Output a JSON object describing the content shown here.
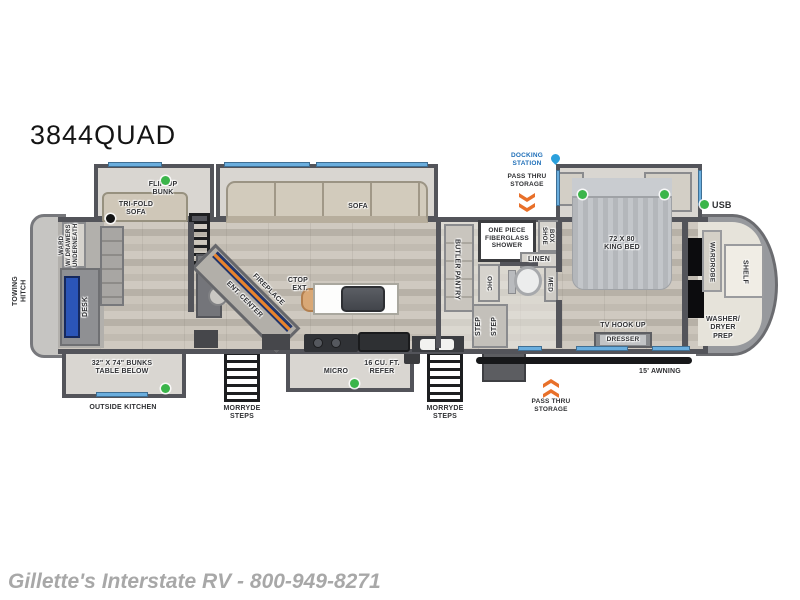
{
  "title": "3844QUAD",
  "footer": "Gillette's Interstate RV - 800-949-8271",
  "labels": {
    "towing_hitch": "TOWING HITCH",
    "ward": "WARD\nW/ DRAWERS\nUNDERNEATH",
    "desk": "DESK",
    "flip_up_bunk": "FLIP-UP\nBUNK",
    "tri_fold_sofa": "TRI-FOLD\nSOFA",
    "sofa": "SOFA",
    "bunks_table": "32\" X 74\" BUNKS\nTABLE BELOW",
    "outside_kitchen": "OUTSIDE KITCHEN",
    "morryde_steps": "MORRYDE\nSTEPS",
    "fireplace": "FIREPLACE",
    "ent_center": "ENT. CENTER",
    "ctop_ext": "CTOP\nEXT.",
    "micro": "MICRO",
    "refer": "16 CU. FT.\nREFER",
    "butler_pantry": "BUTLER PANTRY",
    "ohc": "OHC",
    "step": "STEP",
    "shower": "ONE PIECE\nFIBERGLASS\nSHOWER",
    "shoe_box": "SHOE\nBOX",
    "linen": "LINEN",
    "med": "MED",
    "docking_station": "DOCKING\nSTATION",
    "pass_thru_storage": "PASS THRU\nSTORAGE",
    "king_bed": "72 X 80\nKING BED",
    "usb": "USB",
    "tv_hook_up": "TV HOOK UP",
    "dresser": "DRESSER",
    "wardrobe": "WARDROBE",
    "shelf": "SHELF",
    "washer_dryer_prep": "WASHER/\nDRYER\nPREP",
    "awning": "15' AWNING"
  },
  "colors": {
    "window_blue": "#6aaede",
    "docking_blue": "#1f6fb8",
    "droplet_blue": "#2ba0dc",
    "chevron_orange": "#e8702a",
    "indicator_green": "#3bb54a",
    "wall_gray": "#53545a",
    "desk_blue": "#2b55b8",
    "footer_gray": "#a8a8a8"
  }
}
